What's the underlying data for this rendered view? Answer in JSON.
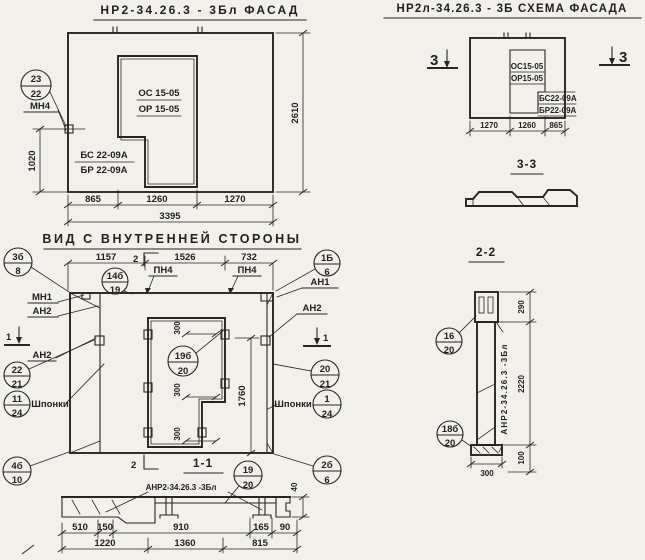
{
  "facade": {
    "title": "НР2-34.26.3 - 3Бл ФАСАД",
    "opening_mark": [
      "ОС 15-05",
      "ОР 15-05"
    ],
    "block_mark": [
      "БС 22-09А",
      "БР 22-09А"
    ],
    "pos_circle": {
      "top": "23",
      "bottom": "22"
    },
    "anchor_label": "МН4",
    "dim_left": "1020",
    "dim_right": "2610",
    "dims_bottom": [
      "865",
      "1260",
      "1270"
    ],
    "dim_total": "3395"
  },
  "schema": {
    "title": "НР2л-34.26.3 - 3Б СХЕМА ФАСАДА",
    "opening_mark": [
      "ОС15-05",
      "ОР15-05"
    ],
    "block_mark": [
      "БС22-09А",
      "БР22-09А"
    ],
    "section_mark": "3",
    "dims_bottom": [
      "1270",
      "1260",
      "865"
    ]
  },
  "section33": {
    "title": "3-3"
  },
  "inner_view": {
    "title": "ВИД С ВНУТРЕННЕЙ СТОРОНЫ",
    "dims_top": [
      "1157",
      "1526",
      "732"
    ],
    "cut1": "1",
    "cut2": "2",
    "labels": {
      "mn1": "МН1",
      "an2_left_top": "АН2",
      "an2_left": "АН2",
      "pn4_left": "ПН4",
      "pn4_right": "ПН4",
      "an1": "АН1",
      "an2_right": "АН2",
      "keys_left": "Шпонки",
      "keys_right": "Шпонки"
    },
    "circles": {
      "c3b8": {
        "top": "3б",
        "bottom": "8"
      },
      "c14b19": {
        "top": "14б",
        "bottom": "19"
      },
      "c1b6": {
        "top": "1Б",
        "bottom": "6"
      },
      "c2221": {
        "top": "22",
        "bottom": "21"
      },
      "c1124": {
        "top": "11",
        "bottom": "24"
      },
      "c4b10": {
        "top": "4б",
        "bottom": "10"
      },
      "c19b20": {
        "top": "19б",
        "bottom": "20"
      },
      "c2021": {
        "top": "20",
        "bottom": "21"
      },
      "c124": {
        "top": "1",
        "bottom": "24"
      },
      "c2b6": {
        "top": "2б",
        "bottom": "6"
      }
    },
    "dim_key": "300",
    "dim_height": "1760"
  },
  "section11": {
    "title": "1-1",
    "label": "АНР2-34.26.3 -3Бл",
    "circle": {
      "top": "19",
      "bottom": "20"
    },
    "dims_row1": [
      "510",
      "150",
      "910",
      "165",
      "90"
    ],
    "dims_row2": [
      "1220",
      "1360",
      "815"
    ],
    "dim_40": "40"
  },
  "section22": {
    "title": "2-2",
    "label": "АНР2-34.26.3 -3Бл",
    "circles": {
      "c1620": {
        "top": "16",
        "bottom": "20"
      },
      "c18b20": {
        "top": "18б",
        "bottom": "20"
      }
    },
    "dims_right": [
      "290",
      "2220",
      "100"
    ],
    "dim_bottom": "300"
  }
}
